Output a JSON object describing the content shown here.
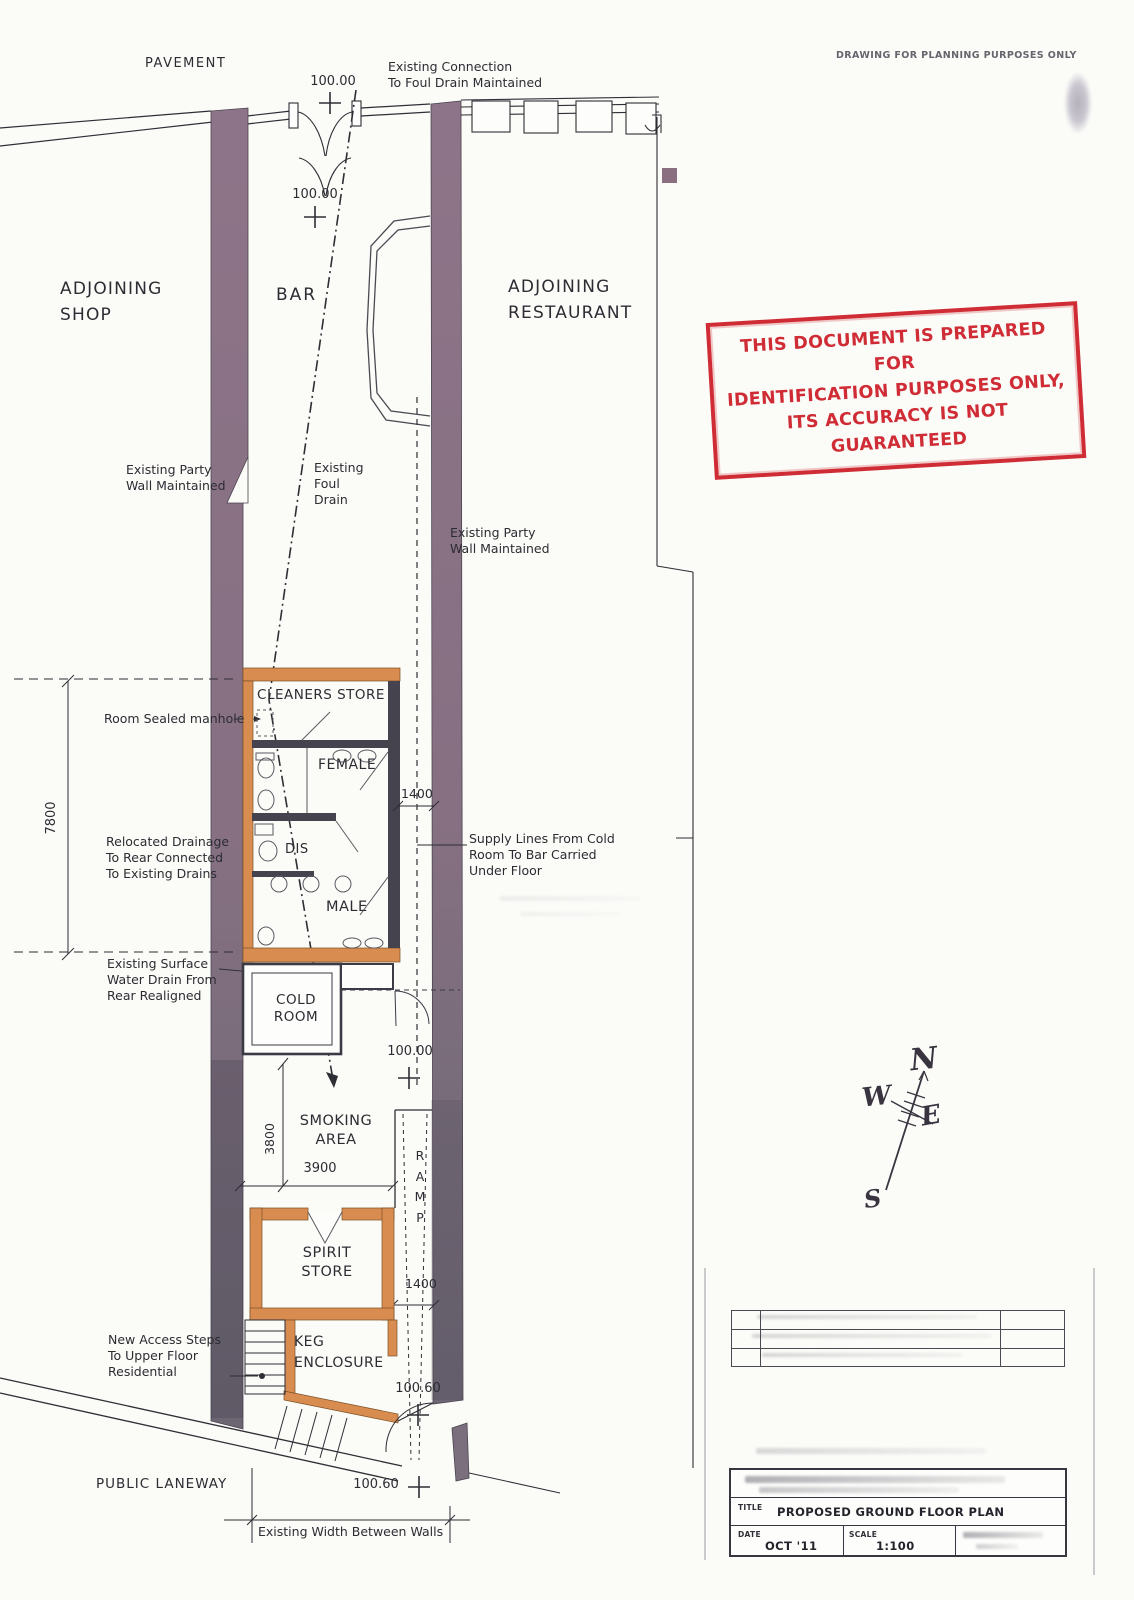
{
  "sheet": {
    "planning_note": "DRAWING FOR PLANNING PURPOSES ONLY"
  },
  "stamp": {
    "line1": "THIS DOCUMENT IS PREPARED FOR",
    "line2": "IDENTIFICATION PURPOSES ONLY,",
    "line3": "ITS ACCURACY IS NOT GUARANTEED",
    "color": "#cf2c35"
  },
  "areas": {
    "pavement": "PAVEMENT",
    "adjoining_shop": "ADJOINING\nSHOP",
    "bar": "BAR",
    "adjoining_restaurant": "ADJOINING\nRESTAURANT",
    "public_laneway": "PUBLIC LANEWAY"
  },
  "rooms": {
    "cleaners_store": "CLEANERS STORE",
    "female": "FEMALE",
    "dis": "DIS",
    "male": "MALE",
    "cold_room": "COLD\nROOM",
    "smoking_area": "SMOKING\nAREA",
    "ramp": "R\nA\nM\nP",
    "spirit_store": "SPIRIT\nSTORE",
    "keg_enclosure": "KEG\nENCLOSURE"
  },
  "annotations": {
    "existing_connection": "Existing Connection\nTo Foul Drain Maintained",
    "party_wall_left": "Existing Party\nWall Maintained",
    "foul_drain": "Existing\nFoul\nDrain",
    "party_wall_right": "Existing Party\nWall Maintained",
    "room_sealed_manhole": "Room Sealed manhole",
    "relocated_drainage": "Relocated Drainage\nTo Rear Connected\nTo Existing Drains",
    "supply_lines": "Supply Lines From Cold\nRoom To Bar Carried\nUnder Floor",
    "surface_water": "Existing Surface\nWater Drain From\nRear Realigned",
    "new_access_steps": "New Access Steps\nTo Upper Floor\nResidential",
    "existing_width": "Existing Width Between Walls"
  },
  "levels": {
    "street": "100.00",
    "bar_front": "100.00",
    "yard": "100.00",
    "keg": "100.60",
    "laneway": "100.60"
  },
  "dimensions": {
    "toilet_block_length": "7800",
    "corridor_top": "1400",
    "corridor_bottom": "1400",
    "smoking_depth": "3800",
    "smoking_width": "3900"
  },
  "compass": {
    "north": "N",
    "west": "W",
    "east": "E",
    "south": "S"
  },
  "title_block": {
    "title_label": "TITLE",
    "title": "PROPOSED GROUND FLOOR PLAN",
    "date_label": "DATE",
    "date": "OCT '11",
    "scale_label": "SCALE",
    "scale": "1:100"
  },
  "colors": {
    "existing_wall": "#8a7183",
    "new_wall": "#d98c50",
    "stamp_red": "#cf2c35"
  }
}
